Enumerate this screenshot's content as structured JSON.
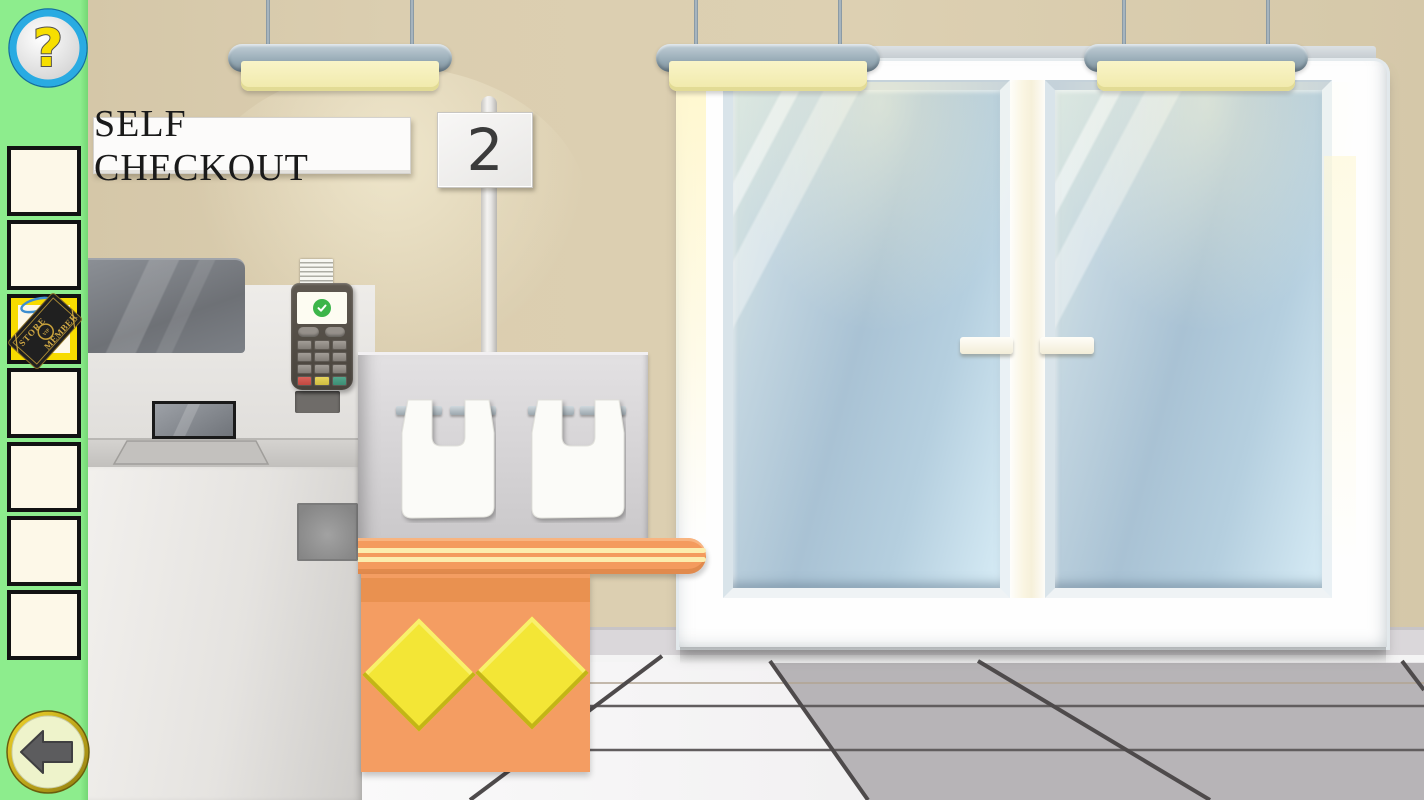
{
  "app": {
    "type": "point-and-click escape game",
    "scene": "supermarket self checkout"
  },
  "sidebar": {
    "background_color": "#8DED8D",
    "help_button": {
      "label": "?",
      "ring_color": "#29ABE2",
      "glyph_color": "#F7DF00"
    },
    "inventory": {
      "slot_count": 7,
      "selected_slot_index": 2,
      "selected_highlight_color": "#F7DB00",
      "item": {
        "name": "store-vip-member-tag",
        "text_top": "STORE",
        "text_middle": "VIP",
        "text_bottom": "MEMBER",
        "tag_color": "#202020",
        "gold_color": "#C9A23A",
        "string_color": "#3E8FD0"
      }
    },
    "back_button": {
      "icon": "arrow-left",
      "ring_color": "#D8B912",
      "face_color": "#EEF3CB"
    }
  },
  "scene": {
    "wall_color": "#D9CBAC",
    "signs": {
      "checkout_sign_text": "SELF CHECKOUT",
      "lane_number": "2"
    },
    "ceiling_lights": {
      "count": 3,
      "housing_color": "#9AAEBA",
      "panel_color": "#F5EFB9"
    },
    "checkout_machine": {
      "monitor_color": "#73767C",
      "body_color": "#E7E5E2",
      "terminal": {
        "body_color": "#565047",
        "screen_color": "#FDFCF2",
        "status_icon": "check-circle",
        "status_color": "#3CB54A",
        "key_row_colors": [
          "#CC4F45",
          "#DCC84E",
          "#46997F"
        ]
      },
      "bags": {
        "count": 2,
        "color": "#FAFAF7"
      }
    },
    "counter": {
      "top_color": "#F49B5E",
      "stripe_color": "#FCEDAE",
      "base_color": "#F49D62",
      "diamond_color": "#F3E636",
      "diamond_count": 2
    },
    "doors": {
      "frame_color": "#FDFDFD",
      "glass_color": "#A9C2D4",
      "handle_color": "#FBF8EA",
      "leaf_count": 2
    },
    "floor": {
      "tile_light": "#F7F6F7",
      "tile_gray": "#B7B4B7",
      "grout_color": "#4E4A4B"
    }
  }
}
